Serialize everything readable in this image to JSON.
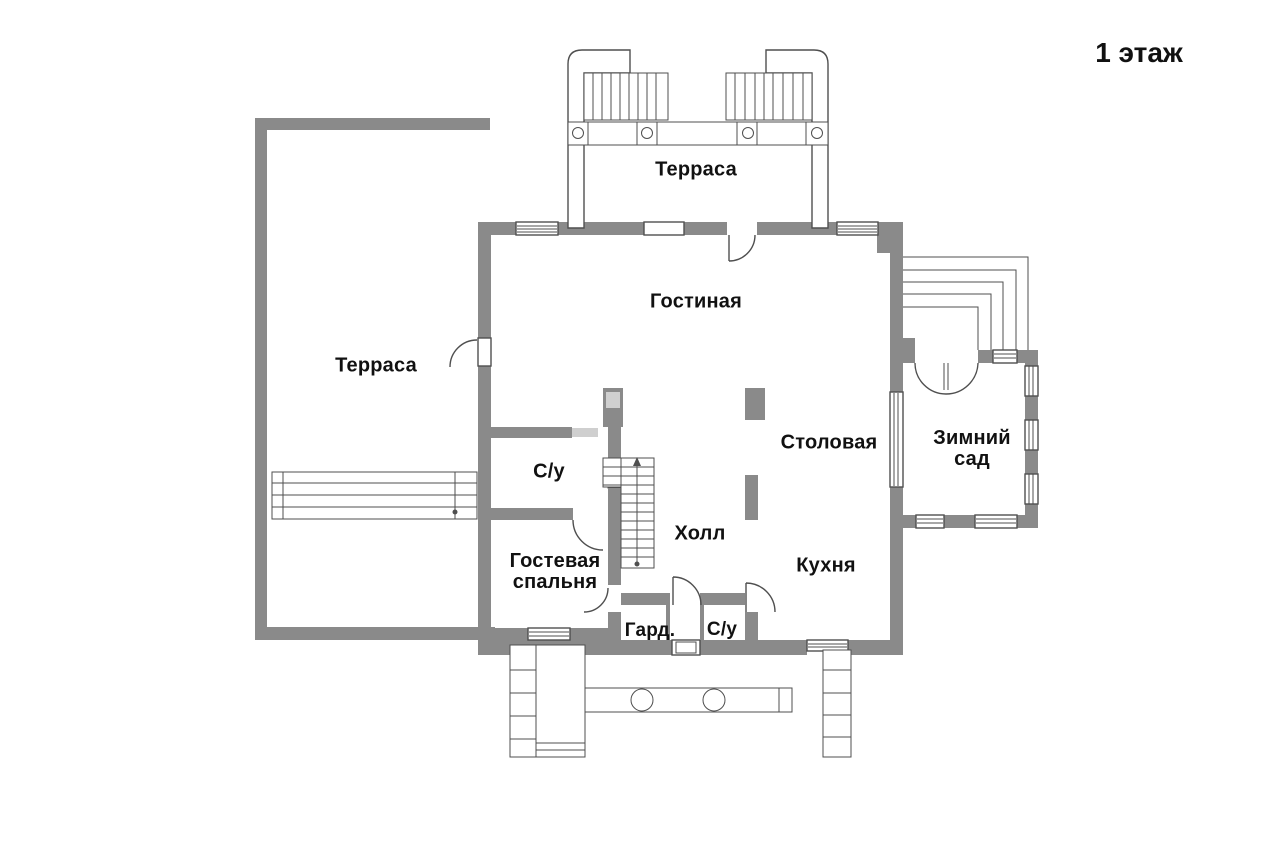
{
  "title": "1 этаж",
  "colors": {
    "wall": "#8a8a8a",
    "wall_light": "#cfcfcf",
    "line": "#4f4f4f",
    "text": "#111111"
  },
  "rooms": [
    {
      "id": "terrace-top",
      "label": "Терраса"
    },
    {
      "id": "terrace-left",
      "label": "Терраса"
    },
    {
      "id": "living-room",
      "label": "Гостиная"
    },
    {
      "id": "dining-room",
      "label": "Столовая"
    },
    {
      "id": "winter-garden",
      "label": "Зимний\nсад"
    },
    {
      "id": "bathroom-1",
      "label": "С/у"
    },
    {
      "id": "hall",
      "label": "Холл"
    },
    {
      "id": "kitchen",
      "label": "Кухня"
    },
    {
      "id": "guest-bedroom",
      "label": "Гостевая\nспальня"
    },
    {
      "id": "wardrobe",
      "label": "Гард."
    },
    {
      "id": "bathroom-2",
      "label": "С/у"
    }
  ]
}
